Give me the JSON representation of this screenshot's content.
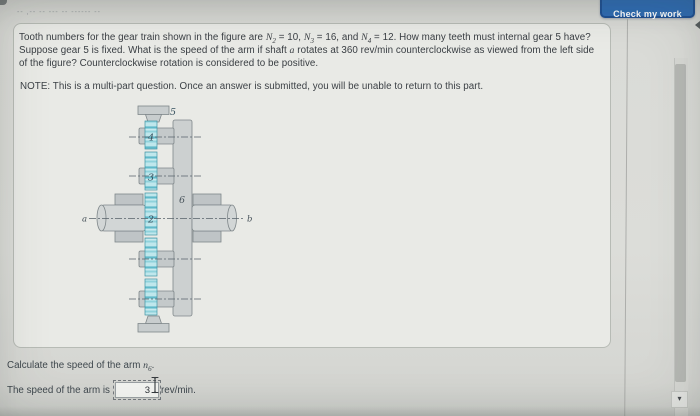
{
  "window": {
    "check_work_label": "Check my work",
    "top_blur_placeholder": "-- ,-- -- --- -- ------ --",
    "scrollbar": {
      "down_icon": "▾"
    }
  },
  "question": {
    "segments": [
      {
        "text": "Tooth numbers for the gear train shown in the figure are "
      },
      {
        "text": "N",
        "italic": true,
        "sub": "2"
      },
      {
        "text": " = 10, "
      },
      {
        "text": "N",
        "italic": true,
        "sub": "3"
      },
      {
        "text": " = 16, and "
      },
      {
        "text": "N",
        "italic": true,
        "sub": "4"
      },
      {
        "text": " = 12. How many teeth must internal gear 5 have? Suppose gear 5 is fixed. What is the speed of the arm if shaft "
      },
      {
        "text": "a",
        "italic": true
      },
      {
        "text": " rotates at 360 rev/min counterclockwise as viewed from the left side of the figure? Counterclockwise rotation is considered to be positive."
      }
    ],
    "note": "NOTE: This is a multi-part question. Once an answer is submitted, you will be unable to return to this part."
  },
  "figure": {
    "labels": {
      "internal_gear": "5",
      "gear4": "4",
      "gear3": "3",
      "gear2": "2",
      "arm": "6",
      "shaft_a": "a",
      "shaft_b": "b"
    },
    "colors": {
      "gear_teal_light": "#bfe7ec",
      "gear_teal_dark": "#5fb9c9",
      "metal_gray": "#cdd1d1",
      "outline": "#7f878a",
      "centerline": "#57626a"
    }
  },
  "answer": {
    "instruction_segments": [
      {
        "text": "Calculate the speed of the arm "
      },
      {
        "text": "n",
        "italic": true,
        "sub": "6"
      },
      {
        "text": "."
      }
    ],
    "prefix": "The speed of the arm is",
    "input_value": "3",
    "unit": "rev/min."
  },
  "theme": {
    "button_blue": "#2e6cb4",
    "button_border": "#1e5094",
    "card_bg": "#e9eae6",
    "page_bg": "#dcddd9"
  }
}
